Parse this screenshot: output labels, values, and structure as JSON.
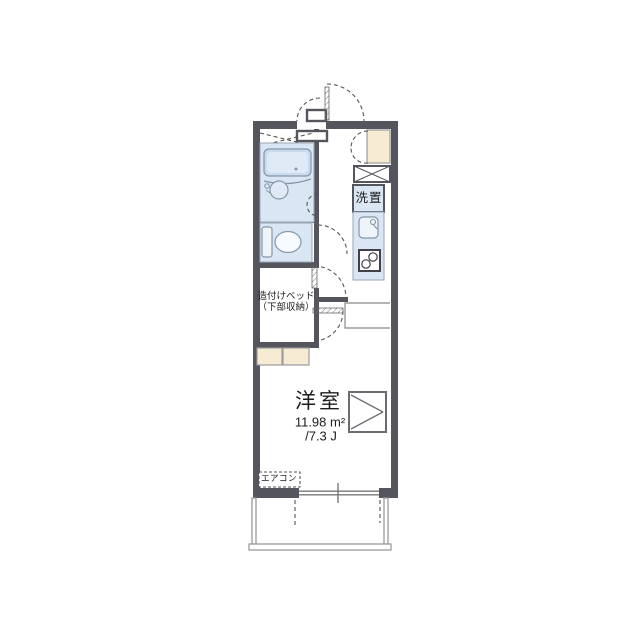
{
  "labels": {
    "washing_machine": "洗置",
    "built_in_bed_line1": "造付けベッド",
    "built_in_bed_line2": "（下部収納）",
    "room_name": "洋室",
    "room_area_sqm": "11.98 m²",
    "room_area_tatami": "/7.3 J",
    "air_conditioner": "エアコン"
  },
  "room": {
    "name": "洋室",
    "area_sqm": 11.98,
    "area_tatami_jou": 7.3
  },
  "colors": {
    "wall": "#54555d",
    "room": "#dae6f3",
    "roomline": "#98a6b5",
    "fixline": "#8496a9",
    "thin": "#9b9b9b",
    "dash": "#555555",
    "text": "#1c1c1c",
    "tub": "#c9dbee",
    "tub_inner": "#dfeaf6",
    "fixture": "#eef4fa",
    "cream": "#f6ecd4",
    "stove": "#3f4048",
    "window": "#777777"
  }
}
